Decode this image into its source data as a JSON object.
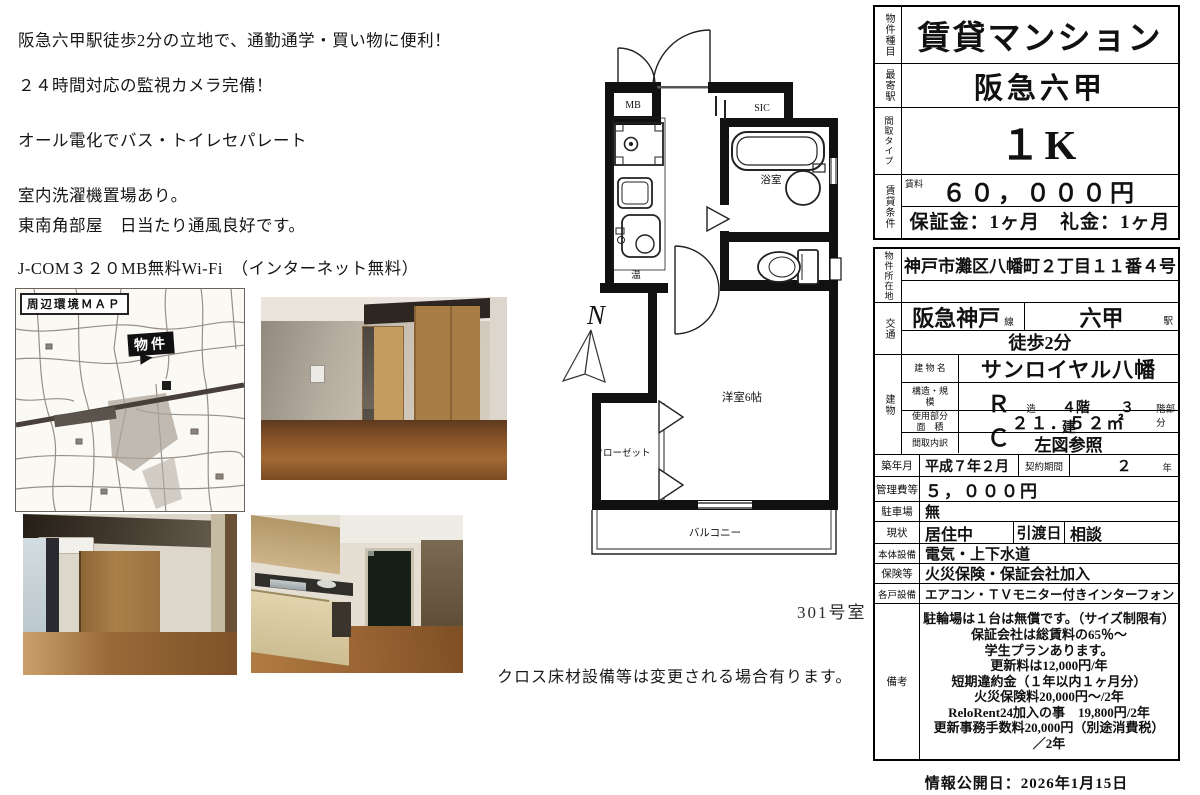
{
  "features": {
    "lines": [
      "阪急六甲駅徒歩2分の立地で、通勤通学・買い物に便利！",
      "２４時間対応の監視カメラ完備！",
      "オール電化でバス・トイレセパレート",
      "室内洗濯機置場あり。",
      "東南角部屋　日当たり通風良好です。",
      "J-COM３２０MB無料Wi-Fi　（インターネット無料）"
    ]
  },
  "map": {
    "title": "周辺環境ＭＡＰ",
    "marker": "物件"
  },
  "floorplan": {
    "mb": "MB",
    "sic": "SIC",
    "bath": "浴室",
    "hot": "温",
    "room": "洋室6帖",
    "closet": "クローゼット",
    "balcony": "バルコニー",
    "north": "N",
    "room_no": "301号室",
    "note": "クロス床材設備等は変更される場合有ります。"
  },
  "spec": {
    "property_type_label": "物件種目",
    "property_type": "賃貸マンション",
    "station_label": "最寄駅",
    "station": "阪急六甲",
    "layout_label": "間取タイプ",
    "layout": "１K",
    "terms_label": "賃貸条件",
    "rent_label": "賃料",
    "rent": "６０，０００円",
    "deposit": "保証金：1ヶ月　礼金：1ヶ月",
    "address_label": "物件所在地",
    "address": "神戸市灘区八幡町２丁目１１番４号",
    "transport_label": "交通",
    "line": "阪急神戸",
    "line_unit": "線",
    "station_name": "六甲",
    "station_unit": "駅",
    "walk": "徒歩2分",
    "building_label": "建物",
    "building_name_label": "建 物 名",
    "building_name": "サンロイヤル八幡",
    "structure_label": "構造・規\n模",
    "structure": "ＲＣ",
    "structure_u1": "造",
    "floors": "４階建",
    "floor": "３",
    "floor_unit": "階部分",
    "area_label": "使用部分\n面　積",
    "area": "２１．５２㎡",
    "madori_label": "間取内訳",
    "madori": "左図参照",
    "built_label": "築年月",
    "built": "平成７年２月",
    "contract_label": "契約期間",
    "contract": "２",
    "contract_unit": "年",
    "mgmt_label": "管理費等",
    "mgmt": "５，０００円",
    "parking_label": "駐車場",
    "parking": "無",
    "status_label": "現状",
    "status": "居住中",
    "handover_label": "引渡日",
    "handover": "相談",
    "base_equip_label": "本体設備",
    "base_equip": "電気・上下水道",
    "insurance_label": "保険等",
    "insurance": "火災保険・保証会社加入",
    "unit_equip_label": "各戸設備",
    "unit_equip": "エアコン・ＴＶモニター付きインターフォン",
    "remarks_label": "備考",
    "remarks": [
      "駐輪場は１台は無償です。（サイズ制限有）",
      "保証会社は総賃料の65％〜",
      "学生プランあります。",
      "更新料は12,000円/年",
      "短期違約金（１年以内１ヶ月分）",
      "火災保険料20,000円〜/2年",
      "ReloRent24加入の事　19,800円/2年",
      "更新事務手数料20,000円（別途消費税）",
      "／2年"
    ]
  },
  "footer": {
    "published": "情報公開日：2026年1月15日"
  }
}
